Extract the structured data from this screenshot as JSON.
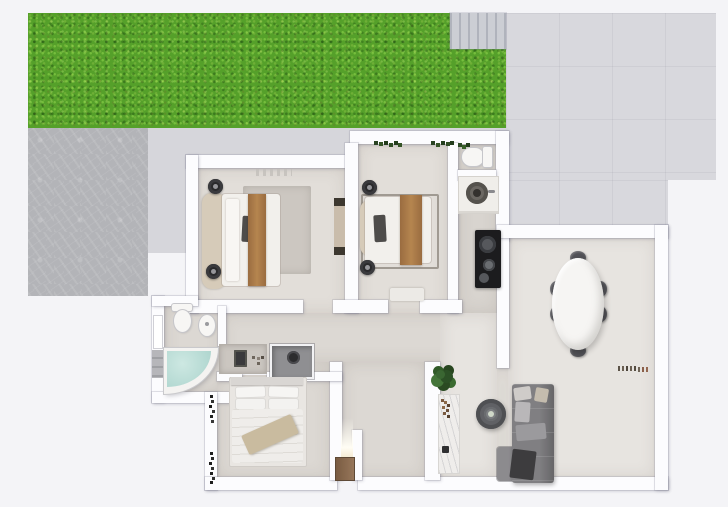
{
  "scene": {
    "type": "3d-rendered-floor-plan-top-view",
    "description": "Top-down 3D architectural rendering of a single-storey apartment with garden lawn, stone patio, tiled terrace, two top bedrooms, WC, kitchen strip, dining area with oval table and six chairs, living area with sofa, bathroom with corner tub, third bedroom and entry hall with front door",
    "visible_text": []
  },
  "palette": {
    "background": "#f4f4f7",
    "grass": "#55a02a",
    "patio_stone": "#b3b4b8",
    "terrace_tile": "#d8d8dd",
    "wall": "#fcfcfe",
    "floor_warm": "#e2ded9",
    "floor_light": "#e7e4e0",
    "bath_water": "#b9dcd6",
    "wood_accent": "#aa7a4a",
    "front_door": "#8a6a4e",
    "sofa_gray": "#807f82",
    "cooktop_black": "#1c1c1e",
    "chair_dark": "#515156",
    "plant_green": "#3a6632"
  },
  "outdoor": {
    "areas": [
      {
        "name": "garden-lawn",
        "position": "top"
      },
      {
        "name": "garden-stairs",
        "position": "top-right-of-lawn",
        "steps": 7
      },
      {
        "name": "tiled-terrace",
        "position": "top-right"
      },
      {
        "name": "stone-patio",
        "position": "left"
      }
    ]
  },
  "rooms": [
    {
      "name": "bedroom-1",
      "position": "top-left",
      "furniture": [
        "double-bed",
        "curved-headboard",
        "brown-bed-runner",
        "dark-accent-pillow",
        "area-rug",
        "round-nightstand",
        "round-nightstand",
        "wall-dresser",
        "wall-decor"
      ]
    },
    {
      "name": "bedroom-2",
      "position": "top-center",
      "furniture": [
        "double-bed",
        "headboard",
        "brown-bed-runner",
        "dark-accent-pillow",
        "round-nightstand",
        "round-nightstand",
        "door-mat",
        "hanging-plant",
        "hanging-plant"
      ]
    },
    {
      "name": "wc",
      "position": "top-right-strip",
      "furniture": [
        "toilet",
        "corner-plant"
      ]
    },
    {
      "name": "kitchen-strip",
      "position": "right-of-bedroom-2",
      "furniture": [
        "counter-with-round-sink",
        "faucet",
        "black-cooktop-with-burners"
      ]
    },
    {
      "name": "dining-area",
      "position": "right",
      "furniture": [
        "oval-dining-table",
        "dining-chair",
        "dining-chair",
        "dining-chair",
        "dining-chair",
        "dining-chair",
        "dining-chair",
        "ledge-decor-items"
      ]
    },
    {
      "name": "living-area",
      "position": "bottom-right",
      "furniture": [
        "l-shaped-sofa",
        "sofa-pillows",
        "dark-throw-blanket",
        "round-coffee-table",
        "console-table",
        "potted-plant"
      ]
    },
    {
      "name": "bathroom",
      "position": "middle-left",
      "furniture": [
        "toilet",
        "bidet",
        "corner-bathtub-with-water",
        "wall-shelf",
        "vanity-counter",
        "shower"
      ]
    },
    {
      "name": "bedroom-3",
      "position": "bottom-left",
      "furniture": [
        "double-bed",
        "four-pillows",
        "tan-blanket",
        "headboard-bar",
        "wall-plant-decor",
        "wall-plant-decor"
      ]
    },
    {
      "name": "entry-hall",
      "position": "bottom-center",
      "furniture": [
        "front-door",
        "door-light-glow"
      ]
    },
    {
      "name": "corridor",
      "position": "center",
      "furniture": []
    }
  ],
  "counts": {
    "bedrooms": 3,
    "dining_chairs": 6,
    "toilets": 2,
    "bathtubs": 1,
    "showers": 1
  }
}
